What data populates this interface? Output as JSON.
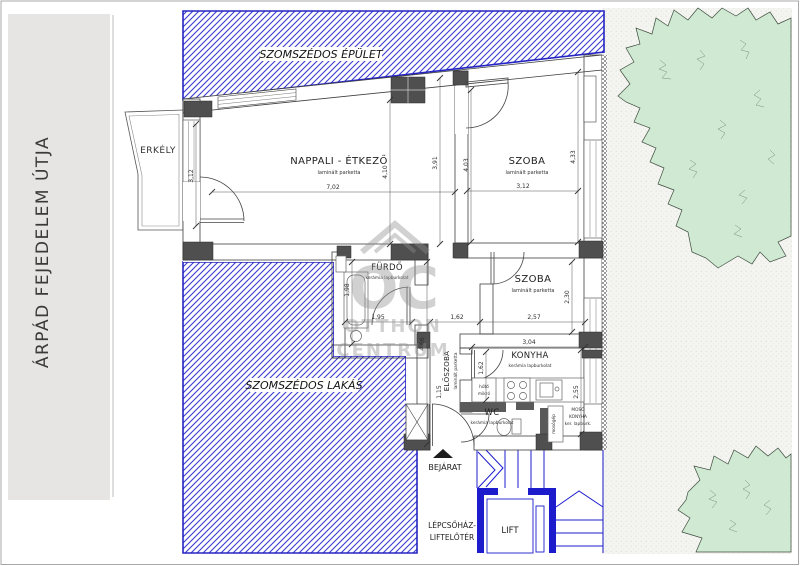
{
  "street": {
    "name": "ÁRPÁD FEJEDELEM ÚTJA"
  },
  "neighbors": {
    "building_label": "SZOMSZÉDOS ÉPÜLET",
    "flat_label": "SZOMSZÉDOS LAKÁS"
  },
  "balcony": {
    "label": "ERKÉLY"
  },
  "rooms": {
    "living": {
      "name": "NAPPALI - ÉTKEZŐ",
      "floor": "laminált parketta",
      "dims": {
        "width": "7,02",
        "height_mid": "4,10",
        "height_right": "3,91",
        "window": "3,12"
      }
    },
    "bedroom1": {
      "name": "SZOBA",
      "floor": "laminált parketta",
      "dims": {
        "height_left": "4,03",
        "height_right": "4,33",
        "width": "3,12"
      }
    },
    "bedroom2": {
      "name": "SZOBA",
      "floor": "laminált parketta",
      "dims": {
        "height": "2,30",
        "width": "2,57"
      }
    },
    "bathroom": {
      "name": "FÜRDŐ",
      "floor": "kerámia lapburkolat",
      "dims": {
        "height": "1,98",
        "width": "1,95"
      }
    },
    "hall": {
      "dims": {
        "width": "1,62"
      }
    },
    "entry_hall": {
      "name": "ELŐSZOBA",
      "floor": "laminált parketta",
      "dims": {
        "length": "4,66",
        "width": "1,15"
      }
    },
    "kitchen": {
      "name": "KONYHA",
      "floor": "kerámia lapburkolat",
      "dims": {
        "width": "3,04",
        "depth_left": "1,62",
        "depth_right": "2,55"
      },
      "appliances": {
        "fridge": "hűtő",
        "microwave": "mikró"
      }
    },
    "wc": {
      "name": "WC",
      "floor": "kerámia lapburkolat"
    },
    "laundry": {
      "name_line1": "MOSÓ",
      "name_line2": "KONYHA",
      "floor": "ker. lapburk.",
      "washer": "mosógép"
    }
  },
  "entrance": {
    "label": "BEJÁRAT"
  },
  "stairwell": {
    "label_line1": "LÉPCSŐHÁZ-",
    "label_line2": "LIFTELŐTÉR",
    "lift_label": "LIFT"
  },
  "watermark": {
    "monogram": "OC",
    "line1": "OTTHON",
    "line2": "CENTRUM"
  },
  "colors": {
    "hatch_blue": "#3a3ad0",
    "hatch_border_blue": "#2525c4",
    "stair_blue": "#1c1ccd",
    "tree_green": "#cfe9d2",
    "wall_gray": "#dedede",
    "pier_dark": "#4f4f4f",
    "street_gray": "#e6e5e3",
    "background_texture": "#f4f4f1"
  }
}
